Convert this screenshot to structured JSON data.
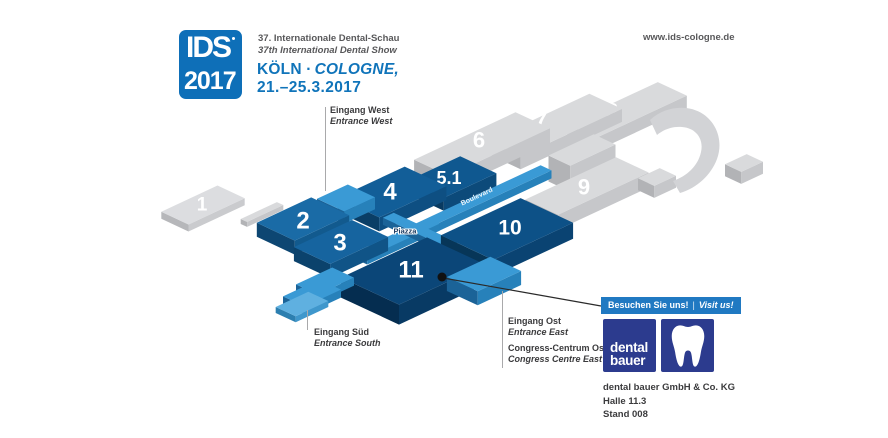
{
  "header": {
    "logo_line1": "IDS",
    "logo_line2": "2017",
    "subtitle_de": "37. Internationale Dental-Schau",
    "subtitle_en": "37th International Dental Show",
    "city_de": "KÖLN ·",
    "city_en": "COLOGNE,",
    "dates": "21.–25.3.2017",
    "website": "www.ids-cologne.de"
  },
  "map": {
    "palettes": {
      "gray": {
        "top": "#d9dadc",
        "left": "#b2b3b6",
        "right": "#c6c7ca"
      },
      "gray1": {
        "top": "#dcdde0",
        "left": "#b6b7ba",
        "right": "#cacbce"
      },
      "b2": {
        "top": "#1a6ba6",
        "left": "#0d4672",
        "right": "#125a8e"
      },
      "b3": {
        "top": "#16649f",
        "left": "#0b426c",
        "right": "#105487"
      },
      "b4": {
        "top": "#125e98",
        "left": "#0a3e66",
        "right": "#0e4f82"
      },
      "b51": {
        "top": "#0f5890",
        "left": "#093a60",
        "right": "#0c4a7a"
      },
      "b10": {
        "top": "#0d5187",
        "left": "#073658",
        "right": "#0a4372"
      },
      "b11": {
        "top": "#0b4678",
        "left": "#052d50",
        "right": "#083a64"
      },
      "light": {
        "top": "#3a9ad5",
        "left": "#1b6398",
        "right": "#2781ba"
      },
      "light2": {
        "top": "#5fb0e0",
        "left": "#2c7fb0",
        "right": "#3f97cc"
      }
    },
    "halls": [
      {
        "id": "8",
        "label": "8",
        "cx": 627,
        "cy": 110,
        "a": 100,
        "b": 32,
        "t": 13,
        "pal": "gray",
        "fs": 22,
        "lx": 612,
        "ly": 111
      },
      {
        "id": "7",
        "label": "7",
        "cx": 555,
        "cy": 125,
        "a": 112,
        "b": 36,
        "t": 13,
        "pal": "gray",
        "fs": 22,
        "lx": 541,
        "ly": 120
      },
      {
        "id": "midblock",
        "label": "",
        "cx": 582,
        "cy": 150,
        "a": 50,
        "b": 24,
        "t": 26,
        "pal": "gray"
      },
      {
        "id": "6",
        "label": "6",
        "cx": 482,
        "cy": 144,
        "a": 112,
        "b": 38,
        "t": 15,
        "pal": "gray",
        "fs": 22,
        "lx": 479,
        "ly": 140
      },
      {
        "id": "9",
        "label": "9",
        "cx": 587,
        "cy": 186,
        "a": 100,
        "b": 36,
        "t": 15,
        "pal": "gray",
        "fs": 22,
        "lx": 584,
        "ly": 187
      },
      {
        "id": "cubeA",
        "label": "",
        "cx": 657,
        "cy": 177,
        "a": 24,
        "b": 18,
        "t": 12,
        "pal": "gray"
      },
      {
        "id": "cubeB",
        "label": "",
        "cx": 744,
        "cy": 163,
        "a": 24,
        "b": 18,
        "t": 12,
        "pal": "gray"
      },
      {
        "id": "1",
        "label": "1",
        "cx": 203,
        "cy": 205,
        "a": 62,
        "b": 30,
        "t": 7,
        "pal": "gray1",
        "fs": 19,
        "lx": 202,
        "ly": 205
      },
      {
        "id": "connector",
        "label": "",
        "cx": 262,
        "cy": 212,
        "a": 40,
        "b": 7,
        "t": 5,
        "pal": "gray"
      },
      {
        "id": "5.1",
        "label": "5.1",
        "cx": 452,
        "cy": 177,
        "a": 58,
        "b": 40,
        "t": 13,
        "pal": "b51",
        "fs": 18,
        "lx": 449,
        "ly": 178
      },
      {
        "id": "4",
        "label": "4",
        "cx": 392,
        "cy": 192,
        "a": 74,
        "b": 46,
        "t": 14,
        "pal": "b4",
        "fs": 24,
        "lx": 390,
        "ly": 192
      },
      {
        "id": "entranceW",
        "label": "",
        "cx": 346,
        "cy": 198,
        "a": 34,
        "b": 30,
        "t": 12,
        "pal": "light"
      },
      {
        "id": "2",
        "label": "2",
        "cx": 303,
        "cy": 219,
        "a": 60,
        "b": 42,
        "t": 14,
        "pal": "b2",
        "fs": 24,
        "lx": 303,
        "ly": 221
      },
      {
        "id": "boulevard",
        "label": "",
        "cx": 460,
        "cy": 208,
        "a": 190,
        "b": 12,
        "t": 8,
        "pal": "light"
      },
      {
        "id": "piazzaU",
        "label": "",
        "cx": 398,
        "cy": 238,
        "a": 80,
        "b": 12,
        "t": 7,
        "pal": "light"
      },
      {
        "id": "piazzaV",
        "label": "",
        "cx": 420,
        "cy": 230,
        "a": 12,
        "b": 70,
        "t": 7,
        "pal": "light"
      },
      {
        "id": "3",
        "label": "3",
        "cx": 341,
        "cy": 242,
        "a": 64,
        "b": 40,
        "t": 14,
        "pal": "b3",
        "fs": 24,
        "lx": 340,
        "ly": 243
      },
      {
        "id": "10",
        "label": "10",
        "cx": 507,
        "cy": 229,
        "a": 88,
        "b": 58,
        "t": 16,
        "pal": "b10",
        "fs": 21,
        "lx": 510,
        "ly": 228
      },
      {
        "id": "11",
        "label": "11",
        "cx": 413,
        "cy": 271,
        "a": 95,
        "b": 64,
        "t": 20,
        "pal": "b11",
        "fs": 24,
        "lx": 411,
        "ly": 270
      },
      {
        "id": "entranceS1",
        "label": "",
        "cx": 325,
        "cy": 281,
        "a": 40,
        "b": 24,
        "t": 8,
        "pal": "light"
      },
      {
        "id": "entranceS2",
        "label": "",
        "cx": 312,
        "cy": 293,
        "a": 40,
        "b": 24,
        "t": 8,
        "pal": "light"
      },
      {
        "id": "entranceS3",
        "label": "",
        "cx": 302,
        "cy": 304,
        "a": 36,
        "b": 22,
        "t": 6,
        "pal": "light2"
      },
      {
        "id": "entranceE",
        "label": "",
        "cx": 484,
        "cy": 274,
        "a": 48,
        "b": 34,
        "t": 14,
        "pal": "light"
      }
    ],
    "extras": [
      {
        "name": "roof-swoosh",
        "fill": "#d2d3d6",
        "d": "M650,120 C665,106 688,104 703,114 C718,124 723,143 717,159 C711,175 697,188 680,193 L673,181 C687,176 698,166 701,152 C704,139 696,128 682,127 C672,126 663,130 657,135 Z"
      }
    ],
    "walk_labels": [
      {
        "text": "Piazza",
        "x": 405,
        "y": 231,
        "fs": 7.5,
        "fill": "#1d3d63",
        "halo": true,
        "rotate": 0
      },
      {
        "text": "Boulevard",
        "x": 477,
        "y": 197,
        "fs": 7,
        "fill": "#eaf4fb",
        "halo": false,
        "rotate": -25
      }
    ],
    "labels": {
      "west": {
        "de": "Eingang West",
        "en": "Entrance West"
      },
      "sued": {
        "de": "Eingang Süd",
        "en": "Entrance South"
      },
      "ost": {
        "de": "Eingang Ost",
        "en": "Entrance East"
      },
      "congress": {
        "de": "Congress-Centrum Ost",
        "en": "Congress Centre East"
      }
    },
    "annotation": {
      "dot_x": 442,
      "dot_y": 277,
      "line_x2": 601,
      "line_y2": 306
    }
  },
  "exhibitor": {
    "badge_de": "Besuchen Sie uns!",
    "badge_sep": "|",
    "badge_en": "Visit us!",
    "logo_line1": "dental",
    "logo_line2": "bauer",
    "company": "dental bauer GmbH & Co. KG",
    "hall": "Halle 11.3",
    "stand": "Stand 008"
  }
}
